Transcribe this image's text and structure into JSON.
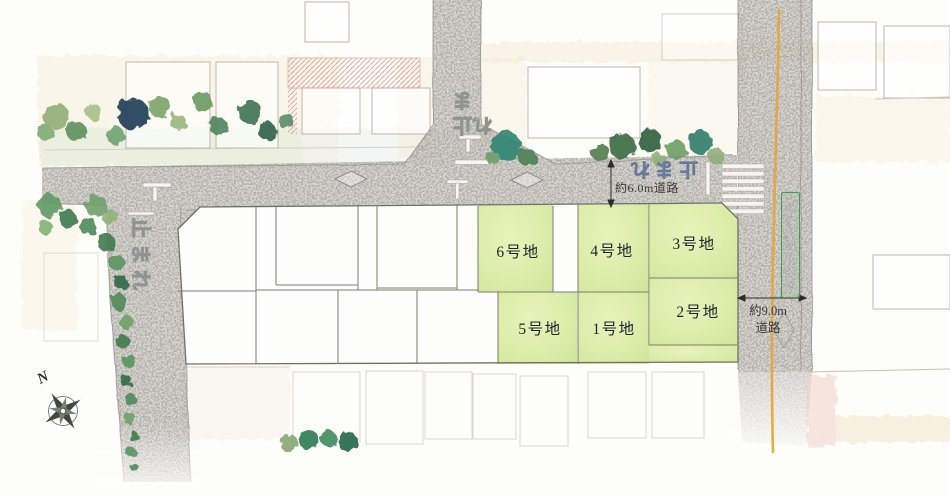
{
  "map": {
    "plots": [
      {
        "label": "1号地"
      },
      {
        "label": "2号地"
      },
      {
        "label": "3号地"
      },
      {
        "label": "4号地"
      },
      {
        "label": "5号地"
      },
      {
        "label": "6号地"
      }
    ],
    "road_labels": {
      "north_road": "約6.0m道路",
      "east_road_line1": "約9.0m",
      "east_road_line2": "道路"
    },
    "road_markings": {
      "stop": "止まれ",
      "zone": "スクールゾーン"
    },
    "compass": {
      "north": "N"
    },
    "colors": {
      "plot_green": "#dcedaa",
      "road_gray": "#b3afaa",
      "center_line_orange": "#e4a63e",
      "zone_border_green": "#3f9e52",
      "marking_blue": "#8399b3"
    }
  }
}
